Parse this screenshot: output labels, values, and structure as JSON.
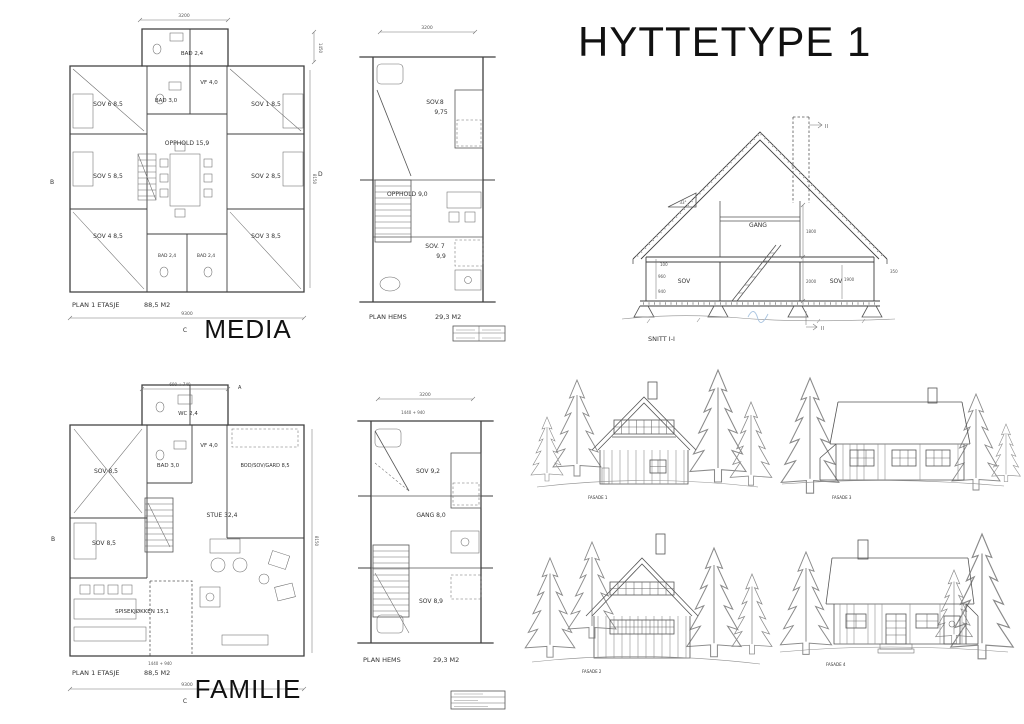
{
  "title": "HYTTETYPE 1",
  "media": {
    "caption": "MEDIA",
    "footer_label": "PLAN 1 ETASJE",
    "footer_area": "88,5 M2",
    "dims": {
      "top": "3200",
      "right_top": "1450",
      "right": "8150",
      "bottom": "9300"
    },
    "axes": {
      "left": "B",
      "bottom": "C",
      "right": "D"
    },
    "rooms": [
      "BAD 2,4",
      "VF 4,0",
      "BAD 3,0",
      "SOV 6  8,5",
      "SOV 1  8,5",
      "OPPHOLD  15,9",
      "SOV 5  8,5",
      "SOV 2  8,5",
      "SOV 4  8,5",
      "SOV 3  8,5",
      "BAD 2,4",
      "BAD 2,4"
    ]
  },
  "media_hems": {
    "footer_label": "PLAN HEMS",
    "footer_area": "29,3  M2",
    "dims": {
      "top": "3200"
    },
    "rooms": [
      "SOV.8",
      "9,75",
      "OPPHOLD 9,0",
      "SOV. 7",
      "9,9"
    ]
  },
  "section": {
    "label": "SNITT I-I",
    "roof_angle": "33°",
    "rooms": [
      "GANG",
      "SOV",
      "SOV"
    ],
    "dims": [
      "1800",
      "2000",
      "100",
      "960",
      "940",
      "1900",
      "350"
    ],
    "marker": "II"
  },
  "familie": {
    "caption": "FAMILIE",
    "footer_label": "PLAN 1 ETASJE",
    "footer_area": "88,5 M2",
    "dims": {
      "top": "690 + 740",
      "bottom": "9300",
      "bottom2": "1440 + 940",
      "right": "8150"
    },
    "axes": {
      "top": "A",
      "left": "B",
      "bottom": "C"
    },
    "rooms": [
      "WC 2,4",
      "BAD 3,0",
      "VF 4,0",
      "SOV  8,5",
      "BOD/SOV/GARD 8,5",
      "SOV 8,5",
      "STUE  32,4",
      "SPISEKJØKKEN 15,1"
    ]
  },
  "familie_hems": {
    "footer_label": "PLAN HEMS",
    "footer_area": "29,3 M2",
    "dims": {
      "top": "3200",
      "top2": "1440 + 940"
    },
    "rooms": [
      "SOV 9,2",
      "GANG 8,0",
      "SOV 8,9"
    ]
  },
  "elevations": [
    {
      "caption": "FASADE 1"
    },
    {
      "caption": "FASADE 3"
    },
    {
      "caption": "FASADE 2"
    },
    {
      "caption": "FASADE 4"
    }
  ]
}
